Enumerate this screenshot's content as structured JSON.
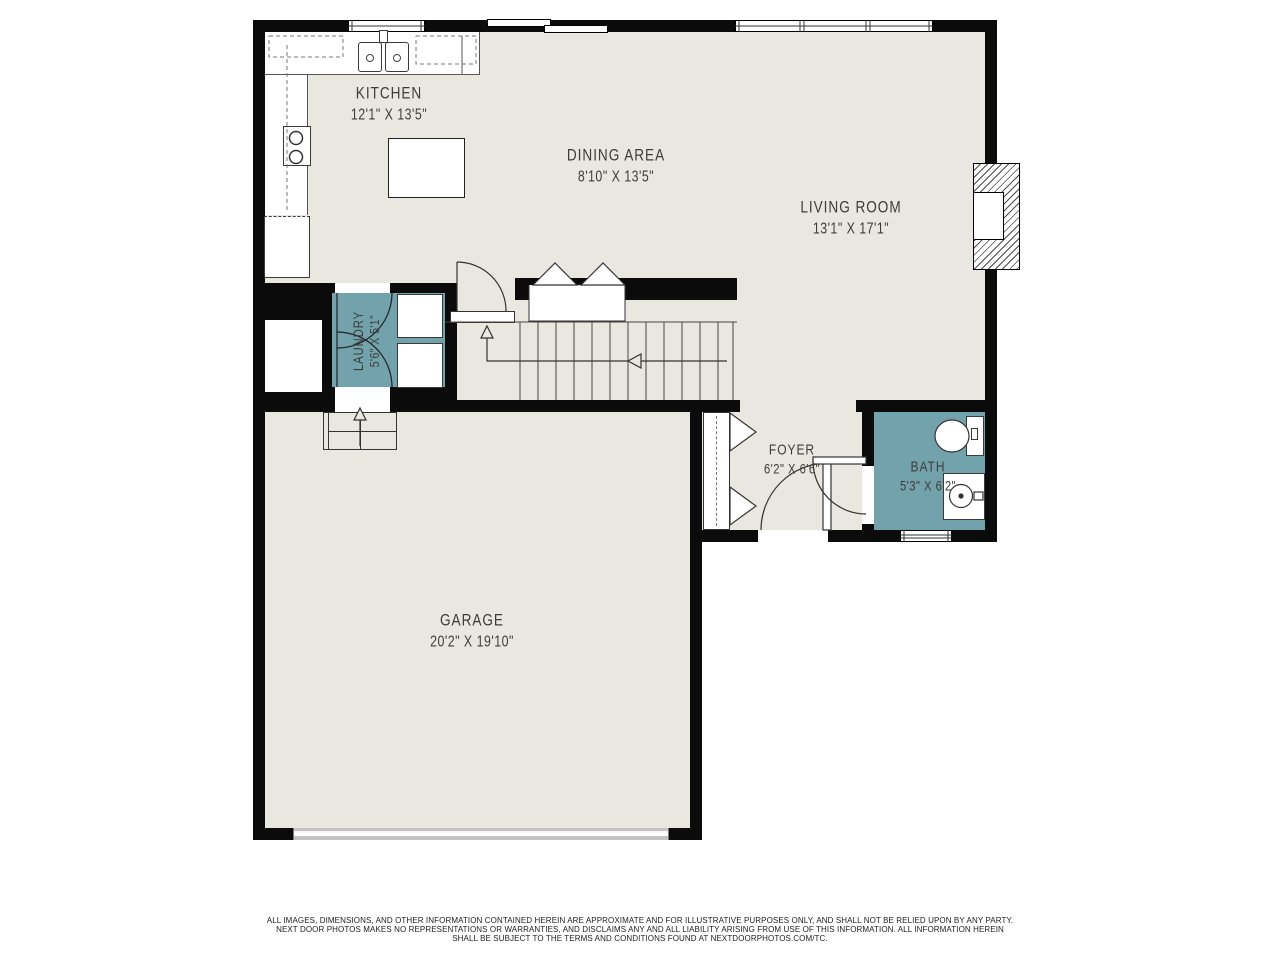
{
  "colors": {
    "wall": "#0b0b0b",
    "floor": "#e9e8e0",
    "accent_room_fill": "#72a3ad",
    "background": "#ffffff",
    "label_text": "#3d3d38"
  },
  "rooms": {
    "kitchen": {
      "name": "KITCHEN",
      "dims": "12'1\" X 13'5\""
    },
    "dining": {
      "name": "DINING AREA",
      "dims": "8'10\" X 13'5\""
    },
    "living": {
      "name": "LIVING ROOM",
      "dims": "13'1\" X 17'1\""
    },
    "laundry": {
      "name": "LAUNDRY",
      "dims": "5'6\" X 5'1\""
    },
    "foyer": {
      "name": "FOYER",
      "dims": "6'2\" X 6'6\""
    },
    "bath": {
      "name": "BATH",
      "dims": "5'3\" X 6'2\""
    },
    "garage": {
      "name": "GARAGE",
      "dims": "20'2\" X 19'10\""
    }
  },
  "disclaimer": {
    "line1": "ALL IMAGES, DIMENSIONS, AND OTHER INFORMATION CONTAINED HEREIN ARE APPROXIMATE AND FOR ILLUSTRATIVE PURPOSES ONLY, AND SHALL NOT BE RELIED UPON BY ANY PARTY.",
    "line2": "NEXT DOOR PHOTOS MAKES NO REPRESENTATIONS OR WARRANTIES, AND DISCLAIMS ANY AND ALL LIABILITY ARISING FROM USE OF THIS INFORMATION. ALL INFORMATION HEREIN",
    "line3": "SHALL BE SUBJECT TO THE TERMS AND CONDITIONS FOUND AT NEXTDOORPHOTOS.COM/TC."
  }
}
